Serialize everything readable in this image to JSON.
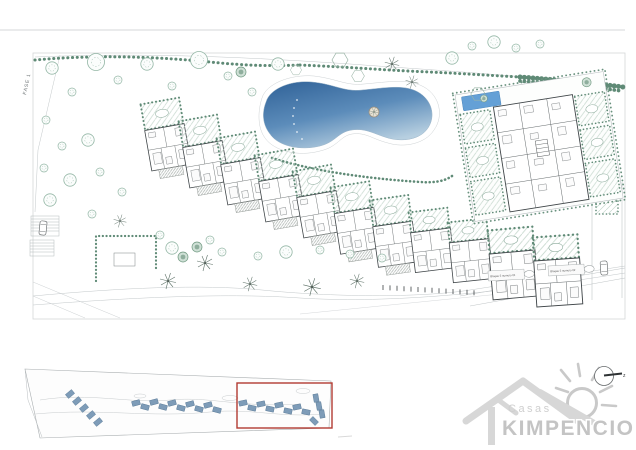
{
  "plan": {
    "fase_label": "FASE 1",
    "block_labels": [
      "Bloque 5 numero 01",
      "Bloque 5 numero 02"
    ]
  },
  "minimap": {
    "description": "linear site overview strip",
    "highlight_color": "#b23b32"
  },
  "logo": {
    "casas": "Casas",
    "brand": "KIMPENCIO"
  },
  "compass": {
    "label": "z"
  },
  "colors": {
    "pool_dark": "#2f6197",
    "pool_mid": "#5c8cba",
    "pool_light": "#b7cfe0",
    "small_pool": "#64a0d6",
    "hedge_green": "#5f8a76",
    "tree_green": "#93b6a5",
    "garden_hatch": "#c6d8cd",
    "building_line": "#3f4548",
    "boundary_gray": "#b9bfc1",
    "minimap_building": "#7e9cb8",
    "highlight_red": "#b23b32",
    "logo_gray": "#c4c4c4"
  }
}
